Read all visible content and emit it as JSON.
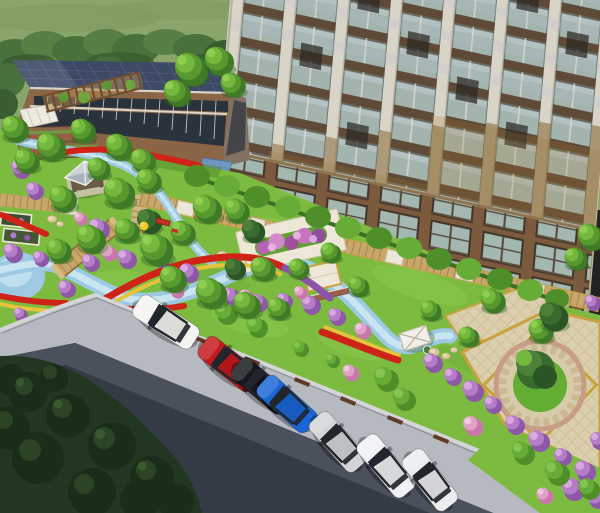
{
  "meta": {
    "title": "Residential community landscape — aerial architectural rendering",
    "canvas": {
      "width": 600,
      "height": 513
    },
    "view": "oblique aerial 3D render"
  },
  "scene": {
    "description": "Aerial rendering of a residential compound: a high-rise apartment tower at upper right, a clubhouse with solar-panel roof at upper left, a central landscaped garden with winding stream, flower beds, gazebo, pergola and boardwalks, a paved plaza with a circular tree island at lower right, and a road with angled roadside parking across the bottom.",
    "elements": [
      "grass field backdrop",
      "tree line",
      "clubhouse with solar roof",
      "residential tower",
      "garden lawn",
      "winding stream",
      "reflecting pool",
      "wood boardwalk",
      "wood bridge",
      "gazebo",
      "pergola",
      "community garden plots",
      "flower planter plaza",
      "paver plaza",
      "central tree ring",
      "flower beds (red/yellow/purple)",
      "shrub masses",
      "hedge row",
      "asphalt road",
      "parking lane",
      "parked cars",
      "wheel stops",
      "dark tree canopy"
    ]
  },
  "colors": {
    "field": "#8aa569",
    "field2": "#7f9a5e",
    "treeline": "#49713b",
    "treeline2": "#3a5c30",
    "treeline3": "#587f44",
    "lawn": "#7cbb40",
    "lawnlt": "#97d058",
    "lawndk": "#64a434",
    "shadowgrn": "#4d8929",
    "roof": "#3d4a66",
    "roofln": "#5a6a8a",
    "brick": "#8a6546",
    "brickdk": "#6e4e34",
    "winband": "#2a323c",
    "trim": "#d9d6ca",
    "endwall": "#837264",
    "canopyW": "#edeadf",
    "canopyB": "#6d9cc9",
    "tpier": "#d8d4c8",
    "tglass": "#a3b4ae",
    "tglasslt": "#c0cbd2",
    "tspan": "#5e4a36",
    "tlav": "#b9c0d2",
    "tbronze": "#8a6a38",
    "tbronze2": "#a87c34",
    "tdark": "#2c2823",
    "tbrick": "#7b5a3e",
    "tbase": "#a3b8b0",
    "tframe": "#40342a",
    "water": "#9dc9e2",
    "watertile": "#cfe8f4",
    "wood": "#c9a66a",
    "woodln": "#a8854e",
    "pale": "#ece7d6",
    "paleln": "#cfc6ac",
    "plaza": "#dccfae",
    "plazaln": "#c9b992",
    "gold": "#c7a23e",
    "ringwall": "#c89d86",
    "isle": "#63ad33",
    "fred": "#cf2317",
    "fyel": "#e5c33c",
    "fpur": "#8a55a8",
    "bp1": "#8d58a8",
    "bp2": "#b57cc8",
    "bp3": "#d9a8e0",
    "bk1": "#c878a8",
    "bk2": "#e0a0c8",
    "bk3": "#f0c8e0",
    "bg1": "#4f8f2a",
    "bg2": "#68ac38",
    "bg3": "#84c450",
    "t1": "#3f7a26",
    "t2": "#57992e",
    "t3": "#74b83e",
    "t4": "#8ecf52",
    "sp1": "#2c5526",
    "sp2": "#3a6b2e",
    "sp3": "#4d8038",
    "road": "#343b45",
    "roadlt": "#4a515c",
    "parking": "#b6bac0",
    "curb": "#d3d5d7",
    "curbsh": "#8b9097",
    "stop": "#5f3b28",
    "stone": "#dcc89e",
    "stoneln": "#b7a378",
    "white": "#f2f0e8",
    "glassdk": "#20262c",
    "gz1": "#ccd3d8",
    "gz2": "#aab3ba",
    "gzpost": "#6a5844",
    "gzfloor": "#6e5c46",
    "dm1": "#223722",
    "dm2": "#1a2c1a",
    "dm3": "#2e4a28",
    "dm4": "#3c6030"
  },
  "buildings": {
    "clubhouse": {
      "label": "clubhouse",
      "roof": "dark blue solar-panel roof",
      "facade": "brick with ribbon windows",
      "extras": [
        "white canopy tent",
        "blue glass entrance canopy"
      ]
    },
    "tower": {
      "label": "high-rise apartment tower",
      "facade": "white piers, glass bays, bronze frames, brick base"
    }
  },
  "cars": [
    {
      "id": "car-1",
      "type": "wagon",
      "color_name": "white",
      "color": "#f4f4f1"
    },
    {
      "id": "car-2",
      "type": "sedan",
      "color_name": "red",
      "color": "#c4191c"
    },
    {
      "id": "car-3",
      "type": "sedan",
      "color_name": "black",
      "color": "#17181d"
    },
    {
      "id": "car-4",
      "type": "sedan",
      "color_name": "blue",
      "color": "#1b66d6"
    },
    {
      "id": "car-5",
      "type": "sedan",
      "color_name": "silver",
      "color": "#d3d5d7"
    },
    {
      "id": "car-6",
      "type": "wagon",
      "color_name": "white",
      "color": "#f0f1f3"
    },
    {
      "id": "car-7",
      "type": "sedan",
      "color_name": "white",
      "color": "#ecedef"
    }
  ],
  "garden": {
    "water_features": [
      "winding stream",
      "blue-tiled pool at left edge",
      "upper stream branch past gazebo"
    ],
    "structures": [
      "gazebo with pyramidal roof",
      "pergola",
      "wood bridge",
      "white pavilion by stream end",
      "planter plaza with raised flower bed",
      "paver platform",
      "low brick wall",
      "terraced planters",
      "white pillar"
    ],
    "flower_colors": [
      "red",
      "yellow",
      "purple",
      "magenta",
      "pink"
    ],
    "plaza": {
      "border": "gold banding with diamond paver grid",
      "center": "circular stone ring with lawn island and large tree"
    }
  }
}
